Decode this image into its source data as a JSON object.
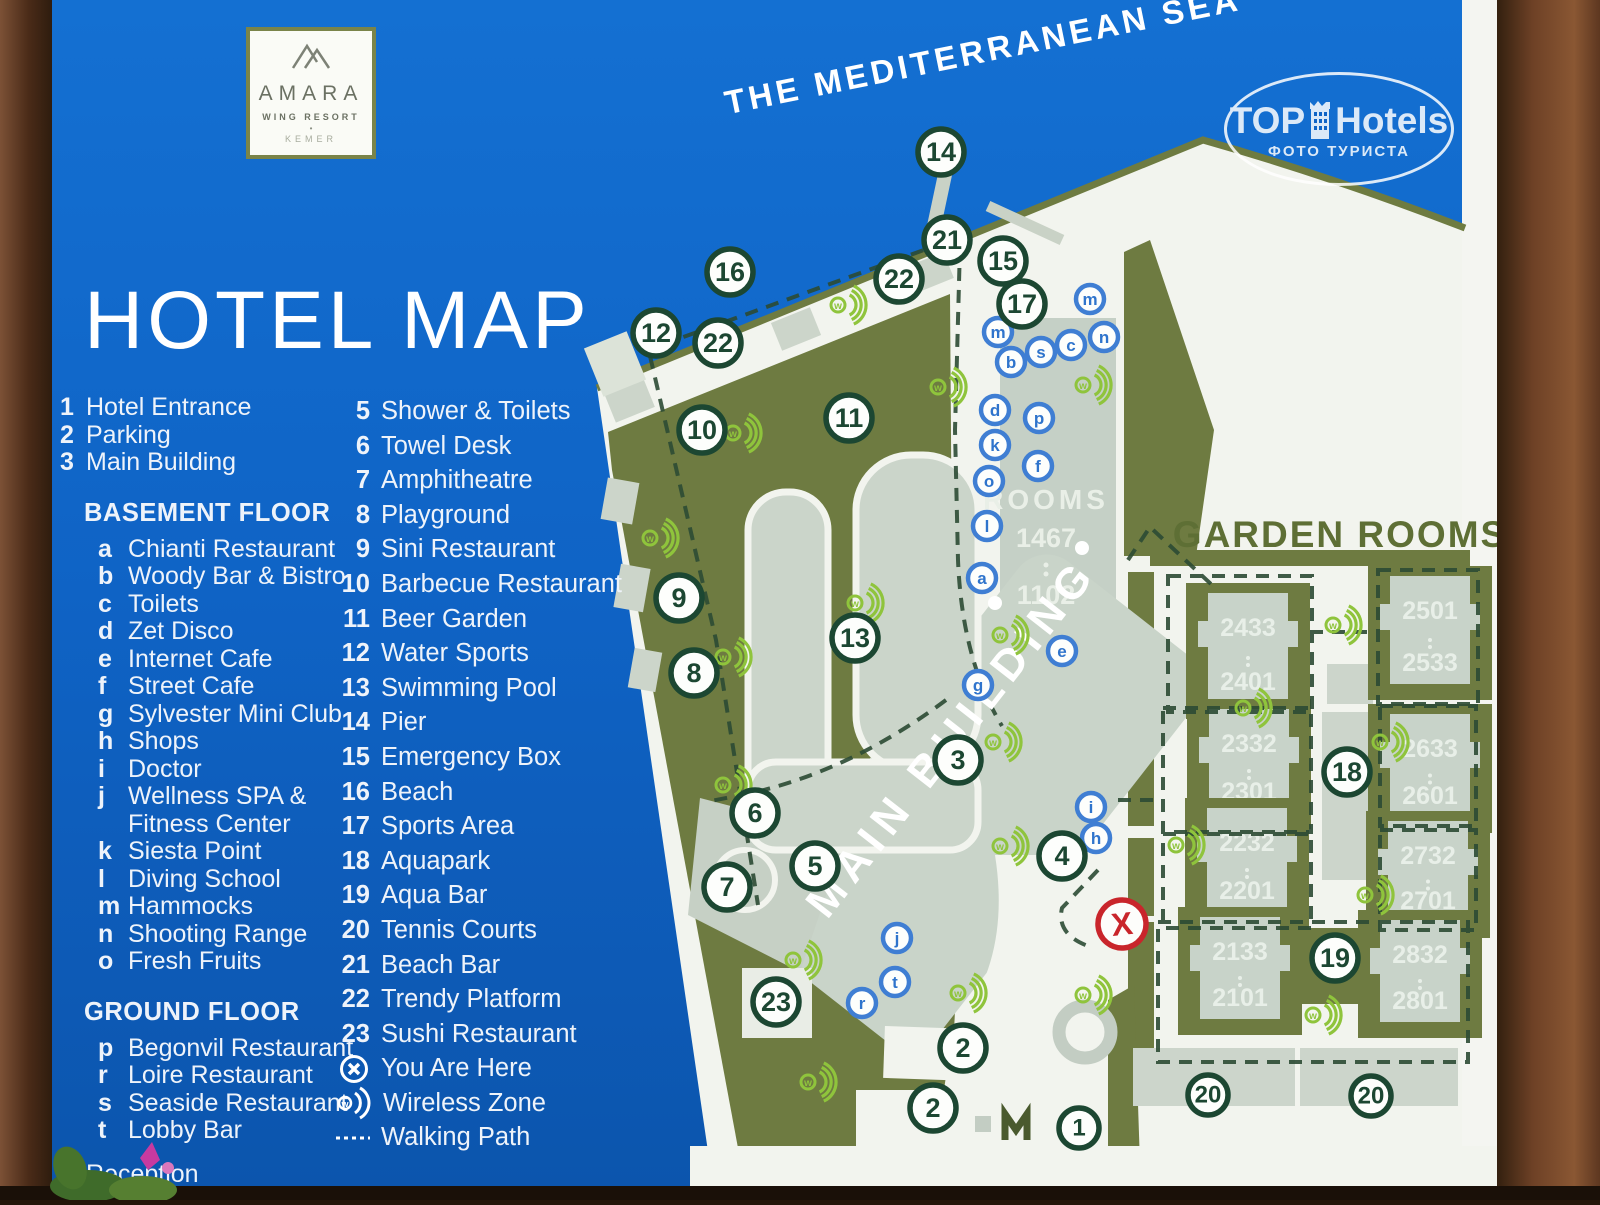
{
  "sign": {
    "logo": {
      "name": "AMARA",
      "sub": "WING RESORT",
      "dot": "•",
      "city": "KEMER"
    },
    "title": "HOTEL MAP",
    "sea_label": "THE MEDITERRANEAN SEA",
    "watermark": {
      "top": "TOP",
      "hotels": "Hotels",
      "sub": "ФОТО ТУРИСТА"
    }
  },
  "legend": {
    "top_items": [
      {
        "key": "1",
        "label": "Hotel Entrance"
      },
      {
        "key": "2",
        "label": "Parking"
      },
      {
        "key": "3",
        "label": "Main Building"
      }
    ],
    "basement_header": "BASEMENT FLOOR",
    "basement_items": [
      {
        "key": "a",
        "label": "Chianti Restaurant"
      },
      {
        "key": "b",
        "label": "Woody Bar & Bistro"
      },
      {
        "key": "c",
        "label": "Toilets"
      },
      {
        "key": "d",
        "label": "Zet Disco"
      },
      {
        "key": "e",
        "label": "Internet Cafe"
      },
      {
        "key": "f",
        "label": "Street Cafe"
      },
      {
        "key": "g",
        "label": "Sylvester Mini Club"
      },
      {
        "key": "h",
        "label": "Shops"
      },
      {
        "key": "i",
        "label": "Doctor"
      },
      {
        "key": "j",
        "label": "Wellness SPA &",
        "label2": "Fitness Center"
      },
      {
        "key": "k",
        "label": "Siesta Point"
      },
      {
        "key": "l",
        "label": "Diving School"
      },
      {
        "key": "m",
        "label": "Hammocks"
      },
      {
        "key": "n",
        "label": "Shooting Range"
      },
      {
        "key": "o",
        "label": "Fresh Fruits"
      }
    ],
    "ground_header": "GROUND FLOOR",
    "ground_items": [
      {
        "key": "p",
        "label": "Begonvil Restaurant"
      },
      {
        "key": "r",
        "label": "Loire Restaurant"
      },
      {
        "key": "s",
        "label": "Seaside Restaurant"
      },
      {
        "key": "t",
        "label": "Lobby Bar"
      }
    ],
    "reception": {
      "key": "4",
      "label": "Reception"
    },
    "col2_items": [
      {
        "key": "5",
        "label": "Shower & Toilets"
      },
      {
        "key": "6",
        "label": "Towel Desk"
      },
      {
        "key": "7",
        "label": "Amphitheatre"
      },
      {
        "key": "8",
        "label": "Playground"
      },
      {
        "key": "9",
        "label": "Sini Restaurant"
      },
      {
        "key": "10",
        "label": "Barbecue Restaurant"
      },
      {
        "key": "11",
        "label": "Beer Garden"
      },
      {
        "key": "12",
        "label": "Water Sports"
      },
      {
        "key": "13",
        "label": "Swimming Pool"
      },
      {
        "key": "14",
        "label": "Pier"
      },
      {
        "key": "15",
        "label": "Emergency Box"
      },
      {
        "key": "16",
        "label": "Beach"
      },
      {
        "key": "17",
        "label": "Sports Area"
      },
      {
        "key": "18",
        "label": "Aquapark"
      },
      {
        "key": "19",
        "label": "Aqua Bar"
      },
      {
        "key": "20",
        "label": "Tennis Courts"
      },
      {
        "key": "21",
        "label": "Beach Bar"
      },
      {
        "key": "22",
        "label": "Trendy Platform"
      },
      {
        "key": "23",
        "label": "Sushi Restaurant"
      }
    ],
    "extras": {
      "you_are_here": "You Are Here",
      "wireless": "Wireless Zone",
      "walking": "Walking Path"
    }
  },
  "map": {
    "labels": {
      "rooms": "ROOMS",
      "rooms_hi": "1467",
      "rooms_lo": "1102",
      "garden_rooms": "GARDEN ROOMS",
      "main_building": "MAIN BUILDING"
    },
    "markers": [
      {
        "n": "14",
        "x": 941,
        "y": 152
      },
      {
        "n": "21",
        "x": 947,
        "y": 240
      },
      {
        "n": "15",
        "x": 1003,
        "y": 261
      },
      {
        "n": "16",
        "x": 730,
        "y": 272
      },
      {
        "n": "22",
        "x": 899,
        "y": 279
      },
      {
        "n": "17",
        "x": 1022,
        "y": 304
      },
      {
        "n": "12",
        "x": 656,
        "y": 333
      },
      {
        "n": "22",
        "x": 718,
        "y": 343
      },
      {
        "n": "11",
        "x": 849,
        "y": 418
      },
      {
        "n": "10",
        "x": 702,
        "y": 430
      },
      {
        "n": "9",
        "x": 679,
        "y": 598
      },
      {
        "n": "13",
        "x": 855,
        "y": 638
      },
      {
        "n": "8",
        "x": 694,
        "y": 673
      },
      {
        "n": "3",
        "x": 958,
        "y": 760
      },
      {
        "n": "6",
        "x": 755,
        "y": 813
      },
      {
        "n": "5",
        "x": 815,
        "y": 866
      },
      {
        "n": "7",
        "x": 727,
        "y": 887
      },
      {
        "n": "4",
        "x": 1062,
        "y": 856
      },
      {
        "n": "23",
        "x": 776,
        "y": 1002
      },
      {
        "n": "2",
        "x": 963,
        "y": 1048
      },
      {
        "n": "2",
        "x": 933,
        "y": 1108
      },
      {
        "n": "1",
        "x": 1079,
        "y": 1128,
        "r": 20
      },
      {
        "n": "18",
        "x": 1347,
        "y": 772
      },
      {
        "n": "19",
        "x": 1335,
        "y": 958
      },
      {
        "n": "20",
        "x": 1208,
        "y": 1095,
        "r": 20
      },
      {
        "n": "20",
        "x": 1371,
        "y": 1096,
        "r": 20
      }
    ],
    "letters": [
      {
        "n": "m",
        "x": 1090,
        "y": 299
      },
      {
        "n": "m",
        "x": 998,
        "y": 332
      },
      {
        "n": "b",
        "x": 1011,
        "y": 362
      },
      {
        "n": "s",
        "x": 1041,
        "y": 352
      },
      {
        "n": "c",
        "x": 1071,
        "y": 345
      },
      {
        "n": "n",
        "x": 1104,
        "y": 337
      },
      {
        "n": "d",
        "x": 995,
        "y": 410
      },
      {
        "n": "p",
        "x": 1039,
        "y": 418
      },
      {
        "n": "k",
        "x": 995,
        "y": 445
      },
      {
        "n": "f",
        "x": 1038,
        "y": 466
      },
      {
        "n": "o",
        "x": 989,
        "y": 481
      },
      {
        "n": "l",
        "x": 987,
        "y": 526
      },
      {
        "n": "a",
        "x": 982,
        "y": 578
      },
      {
        "n": "e",
        "x": 1062,
        "y": 651
      },
      {
        "n": "g",
        "x": 978,
        "y": 685
      },
      {
        "n": "i",
        "x": 1091,
        "y": 807
      },
      {
        "n": "h",
        "x": 1096,
        "y": 838
      },
      {
        "n": "j",
        "x": 897,
        "y": 938
      },
      {
        "n": "t",
        "x": 895,
        "y": 982
      },
      {
        "n": "r",
        "x": 862,
        "y": 1003
      }
    ],
    "you_are_here": {
      "label": "X",
      "x": 1122,
      "y": 924
    },
    "wifi_zones": [
      [
        845,
        305
      ],
      [
        945,
        387
      ],
      [
        1090,
        385
      ],
      [
        740,
        433
      ],
      [
        657,
        538
      ],
      [
        862,
        603
      ],
      [
        1007,
        635
      ],
      [
        730,
        657
      ],
      [
        730,
        785
      ],
      [
        1000,
        742
      ],
      [
        1007,
        846
      ],
      [
        800,
        960
      ],
      [
        965,
        993
      ],
      [
        815,
        1082
      ],
      [
        1090,
        995
      ],
      [
        1340,
        625
      ],
      [
        1250,
        708
      ],
      [
        1387,
        742
      ],
      [
        1183,
        845
      ],
      [
        1372,
        895
      ],
      [
        1320,
        1015
      ]
    ],
    "garden_blocks": [
      {
        "hi": "2433",
        "lo": "2401",
        "x": 1248,
        "y1": 627,
        "y2": 681
      },
      {
        "hi": "2501",
        "lo": "2533",
        "x": 1430,
        "y1": 610,
        "y2": 662
      },
      {
        "hi": "2332",
        "lo": "2301",
        "x": 1249,
        "y1": 743,
        "y2": 791
      },
      {
        "hi": "2633",
        "lo": "2601",
        "x": 1430,
        "y1": 748,
        "y2": 795
      },
      {
        "hi": "2232",
        "lo": "2201",
        "x": 1247,
        "y1": 842,
        "y2": 890
      },
      {
        "hi": "2732",
        "lo": "2701",
        "x": 1428,
        "y1": 855,
        "y2": 900
      },
      {
        "hi": "2133",
        "lo": "2101",
        "x": 1240,
        "y1": 951,
        "y2": 997
      },
      {
        "hi": "2832",
        "lo": "2801",
        "x": 1420,
        "y1": 954,
        "y2": 1000
      }
    ]
  },
  "colors": {
    "panel_blue": "#0f63c5",
    "land_white": "#f2f4ee",
    "olive_green": "#6e7b41",
    "path_gray": "#c9d3c8",
    "marker_green": "#1c4732",
    "letter_blue": "#3f7ed3",
    "wifi_green": "#8fc43c",
    "you_are_here_red": "#c9252b",
    "frame_brown": "#5d3720"
  }
}
